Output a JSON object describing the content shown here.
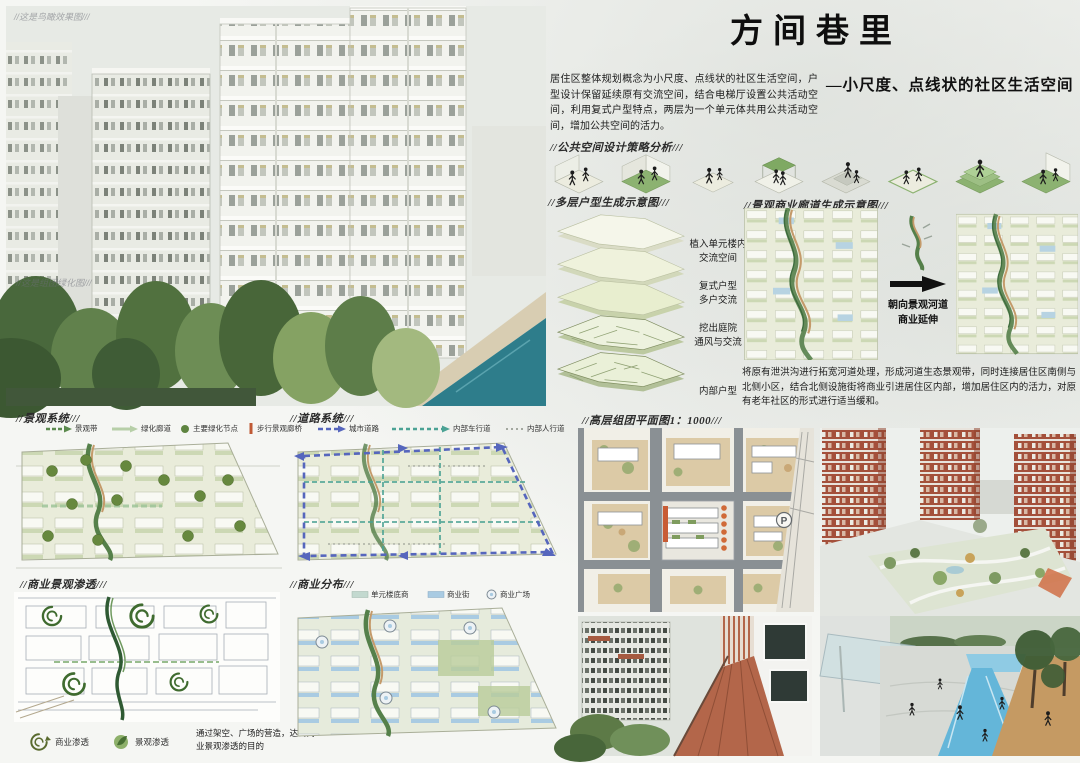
{
  "title": "方间巷里",
  "subtitle": "—小尺度、点线状的社区生活空间",
  "intro": "居住区整体规划概念为小尺度、点线状的社区生活空间，户型设计保留延续原有交流空间，结合电梯厅设置公共活动空间，利用复式户型特点，两层为一个单元体共用公共活动空间，增加公共空间的活力。",
  "watermarks": {
    "hero_top": "//这是鸟瞰效果图///",
    "hero_mid": "//这是组团绿化图///"
  },
  "sections": {
    "strategy": "//公共空间设计策略分析///",
    "multi_unit": "//多层户型生成示意图///",
    "corridor": "//景观商业廊道生成示意图///",
    "landscape": "//景观系统///",
    "road": "//道路系统///",
    "highrise": "//高层组团平面图1：1000///",
    "infiltration": "//商业景观渗透///",
    "distribution": "//商业分布///"
  },
  "unit_labels": [
    {
      "l1": "植入单元楼内",
      "l2": "交流空间"
    },
    {
      "l1": "复式户型",
      "l2": "多户交流"
    },
    {
      "l1": "挖出庭院",
      "l2": "通风与交流"
    },
    {
      "l1": "内部户型",
      "l2": ""
    }
  ],
  "corridor_note": {
    "l1": "朝向景观河道",
    "l2": "商业延伸"
  },
  "river_text": "将原有泄洪沟进行拓宽河道处理，形成河道生态景观带，同时连接居住区南侧与北侧小区，结合北侧设施街将商业引进居住区内部，增加居住区内的活力，对原有老年社区的形式进行适当缓和。",
  "legends": {
    "landscape": [
      "景观带",
      "绿化廊道",
      "主要绿化节点",
      "步行景观廊桥"
    ],
    "road": [
      "城市道路",
      "内部车行道",
      "内部人行道"
    ],
    "commercial": [
      "单元楼底商",
      "商业街",
      "商业广场"
    ],
    "infiltration": [
      "商业渗透",
      "景观渗透"
    ]
  },
  "infiltration_caption": "通过架空、广场的营造，达到商业景观渗透的目的",
  "highrise": {
    "parking_label": "P"
  },
  "colors": {
    "accent_green": "#66883e",
    "corridor_green": "#55804a",
    "corridor_tan": "#c49a6a",
    "road_blue": "#5666bd",
    "road_teal": "#4ba294",
    "commercial_blue": "#a9cbe2",
    "terracotta": "#a4503b",
    "river_teal": "#2e7d8b"
  }
}
